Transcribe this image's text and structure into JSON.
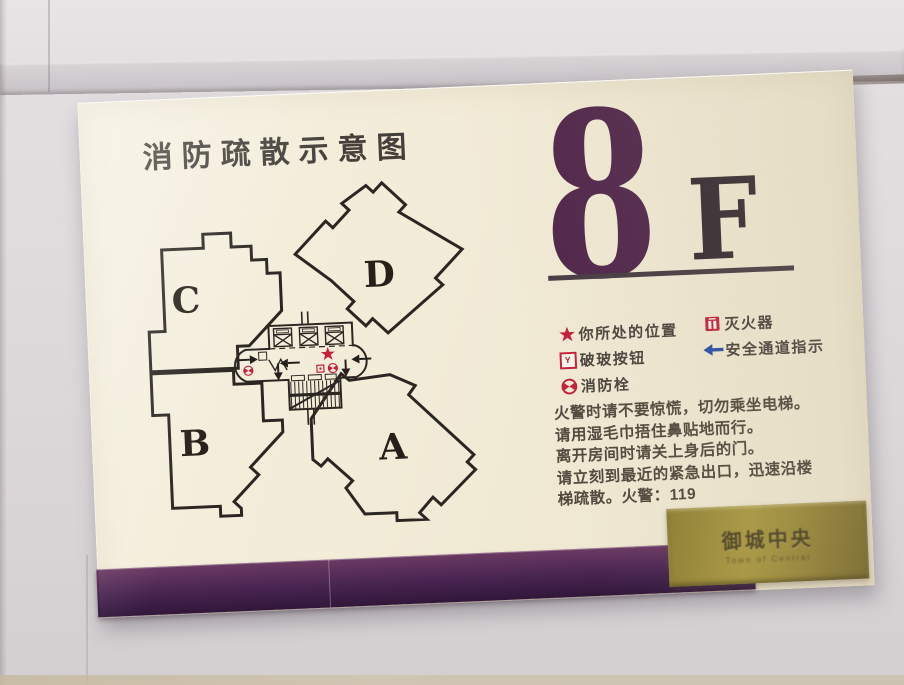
{
  "sign": {
    "title": "消防疏散示意图",
    "floor": {
      "number": "8",
      "suffix": "F"
    },
    "plan": {
      "units": {
        "a": "A",
        "b": "B",
        "c": "C",
        "d": "D"
      }
    },
    "legend": {
      "items": [
        {
          "icon": "location-star",
          "label": "你所处的位置"
        },
        {
          "icon": "break-glass-button",
          "label": "破玻按钮",
          "glyph": "Y"
        },
        {
          "icon": "fire-hydrant",
          "label": "消防栓"
        },
        {
          "icon": "fire-extinguisher",
          "label": "灭火器"
        },
        {
          "icon": "escape-route-arrow",
          "label": "安全通道指示"
        }
      ]
    },
    "instructions": {
      "lines": [
        "火警时请不要惊慌，切勿乘坐电梯。",
        "请用湿毛巾捂住鼻贴地而行。",
        "离开房间时请关上身后的门。",
        "请立刻到最近的紧急出口，迅速沿楼",
        "梯疏散。火警：119"
      ],
      "emergency_number": "119"
    },
    "plaque": {
      "name": "御城中央",
      "subtitle": "Town of Central"
    },
    "colors": {
      "accent_purple": "#50264b",
      "band_purple": "#472450",
      "legend_red": "#c5203a",
      "route_blue": "#2a4fa2",
      "plaque_gold": "#a89842",
      "sign_cream": "#f2ebd7"
    }
  }
}
